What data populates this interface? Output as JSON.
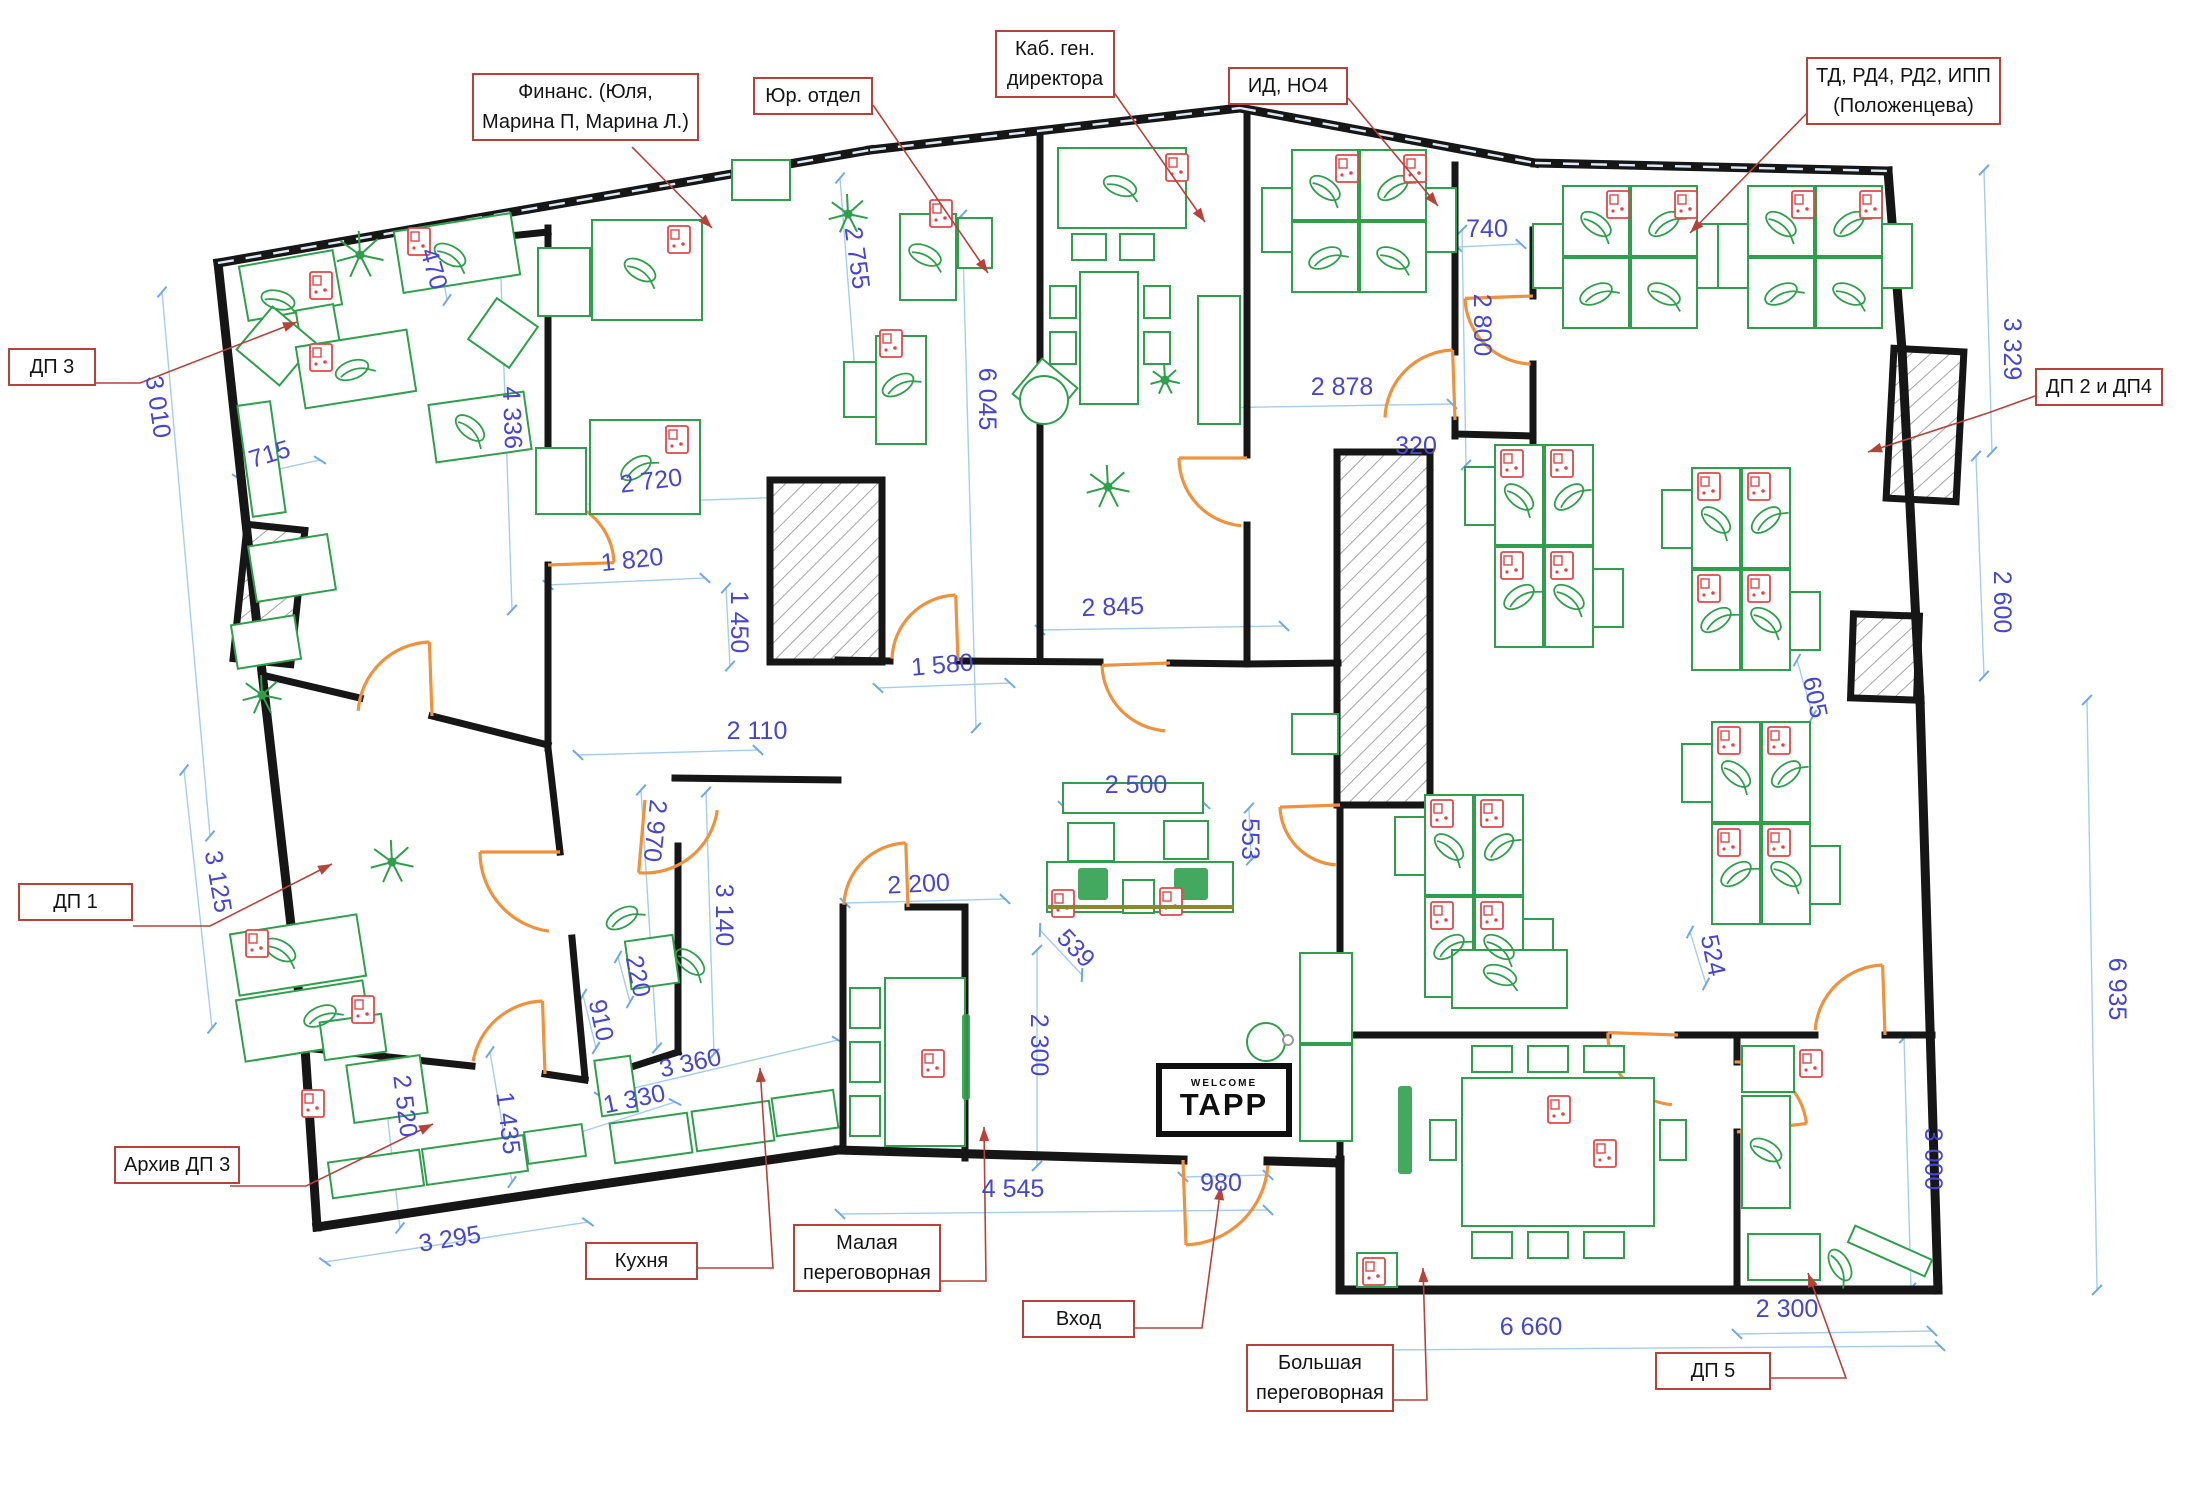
{
  "drawing": {
    "kind": "office floor plan",
    "language": "ru"
  },
  "sign": {
    "welcome": "WELCOME",
    "brand": "TAPP"
  },
  "callouts": [
    {
      "id": "finance",
      "lines": [
        "Финанс. (Юля,",
        "Марина П, Марина Л.)"
      ]
    },
    {
      "id": "legal",
      "lines": [
        "Юр. отдел"
      ]
    },
    {
      "id": "ceo",
      "lines": [
        "Каб. ген.",
        "директора"
      ]
    },
    {
      "id": "id-ho4",
      "lines": [
        "ИД, НО4"
      ]
    },
    {
      "id": "td",
      "lines": [
        "ТД, РД4, РД2, ИПП",
        "(Положенцева)"
      ]
    },
    {
      "id": "dp3",
      "lines": [
        "ДП 3"
      ]
    },
    {
      "id": "dp1",
      "lines": [
        "ДП 1"
      ]
    },
    {
      "id": "archive-dp3",
      "lines": [
        "Архив ДП 3"
      ]
    },
    {
      "id": "kitchen",
      "lines": [
        "Кухня"
      ]
    },
    {
      "id": "small-meeting",
      "lines": [
        "Малая",
        "переговорная"
      ]
    },
    {
      "id": "entrance",
      "lines": [
        "Вход"
      ]
    },
    {
      "id": "big-meeting",
      "lines": [
        "Большая",
        "переговорная"
      ]
    },
    {
      "id": "dp5",
      "lines": [
        "ДП 5"
      ]
    },
    {
      "id": "dp2-dp4",
      "lines": [
        "ДП 2 и ДП4"
      ]
    }
  ],
  "dimensions": [
    {
      "id": "d3010",
      "text": "3 010"
    },
    {
      "id": "d715",
      "text": "715"
    },
    {
      "id": "d470",
      "text": "470"
    },
    {
      "id": "d4336",
      "text": "4 336"
    },
    {
      "id": "d2720",
      "text": "2 720"
    },
    {
      "id": "d1820",
      "text": "1 820"
    },
    {
      "id": "d1450",
      "text": "1 450"
    },
    {
      "id": "d2110",
      "text": "2 110"
    },
    {
      "id": "d2970",
      "text": "2 970"
    },
    {
      "id": "d3140",
      "text": "3 140"
    },
    {
      "id": "d220",
      "text": "220"
    },
    {
      "id": "d910",
      "text": "910"
    },
    {
      "id": "d3360",
      "text": "3 360"
    },
    {
      "id": "d1330",
      "text": "1 330"
    },
    {
      "id": "d3125",
      "text": "3 125"
    },
    {
      "id": "d2520",
      "text": "2 520"
    },
    {
      "id": "d1435",
      "text": "1 435"
    },
    {
      "id": "d3295",
      "text": "3 295"
    },
    {
      "id": "d2755",
      "text": "2 755"
    },
    {
      "id": "d6045",
      "text": "6 045"
    },
    {
      "id": "d1580",
      "text": "1 580"
    },
    {
      "id": "d2845",
      "text": "2 845"
    },
    {
      "id": "d2500",
      "text": "2 500"
    },
    {
      "id": "d553",
      "text": "553"
    },
    {
      "id": "d539",
      "text": "539"
    },
    {
      "id": "d2200",
      "text": "2 200"
    },
    {
      "id": "d2300c",
      "text": "2 300"
    },
    {
      "id": "d4545",
      "text": "4 545"
    },
    {
      "id": "d980",
      "text": "980"
    },
    {
      "id": "d2878",
      "text": "2 878"
    },
    {
      "id": "d320",
      "text": "320"
    },
    {
      "id": "d740",
      "text": "740"
    },
    {
      "id": "d2800",
      "text": "2 800"
    },
    {
      "id": "d3329",
      "text": "3 329"
    },
    {
      "id": "d2600",
      "text": "2 600"
    },
    {
      "id": "d605",
      "text": "605"
    },
    {
      "id": "d524",
      "text": "524"
    },
    {
      "id": "d6935",
      "text": "6 935"
    },
    {
      "id": "d3000",
      "text": "3 000"
    },
    {
      "id": "d6660",
      "text": "6 660"
    },
    {
      "id": "d2300b",
      "text": "2 300"
    }
  ],
  "colors": {
    "wall": "#161616",
    "furniture": "#2ea04c",
    "furniture_fill": "#ffffff",
    "accent_red": "#e04848",
    "dimension_text": "#4646d2",
    "dimension_line": "#a6cdf0",
    "callout": "#b6423a",
    "door": "#f0913c",
    "hatch": "#8f8f8f",
    "olive": "#8a8a2a"
  }
}
